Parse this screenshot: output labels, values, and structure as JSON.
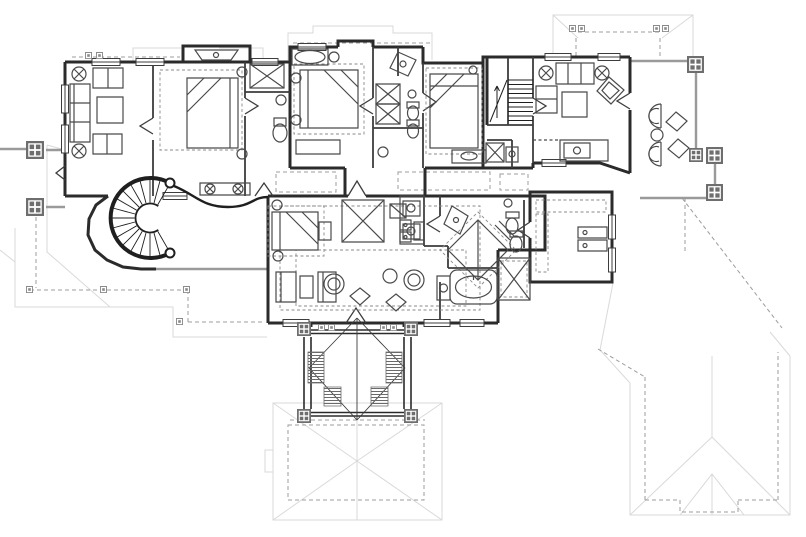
{
  "title": "Second floor architectural plan",
  "canvas": {
    "width": 806,
    "height": 537
  },
  "colors": {
    "background": "#ffffff",
    "wall": "#2b2b2b",
    "partition": "#3d3d3d",
    "furniture": "#4a4a4a",
    "dashed": "#8a8a8a",
    "roof_light": "#d9d9d9",
    "roof_dashed": "#9c9c9c",
    "railing": "#9a9a9a",
    "post": "#6e6e6e",
    "stair": "#1f1f1f",
    "hatch": "#6a6a6a"
  },
  "features": {
    "stairs": [
      "spiral-staircase",
      "straight-staircase"
    ],
    "beds": 5,
    "bathing_fixtures": [
      "oval-tub",
      "master-tub",
      "corner-shower",
      "corner-shower-2",
      "shower-stall"
    ],
    "toilets": 5,
    "sinks": 8,
    "seating_groups": [
      "left-sitting-room",
      "family-room",
      "lounge-sitting-area",
      "deck-furniture"
    ],
    "closets_with_x": 5,
    "fireplace": 1,
    "wet_bar": 1,
    "laundry_appliances": 2,
    "deck_posts": 5,
    "tower_posts": 4,
    "roof_outlines": [
      "top-right-porch-roof",
      "left-porch-roof",
      "entry-tower-roof",
      "lower-right-wing-roof",
      "porte-cochere-roof"
    ]
  }
}
